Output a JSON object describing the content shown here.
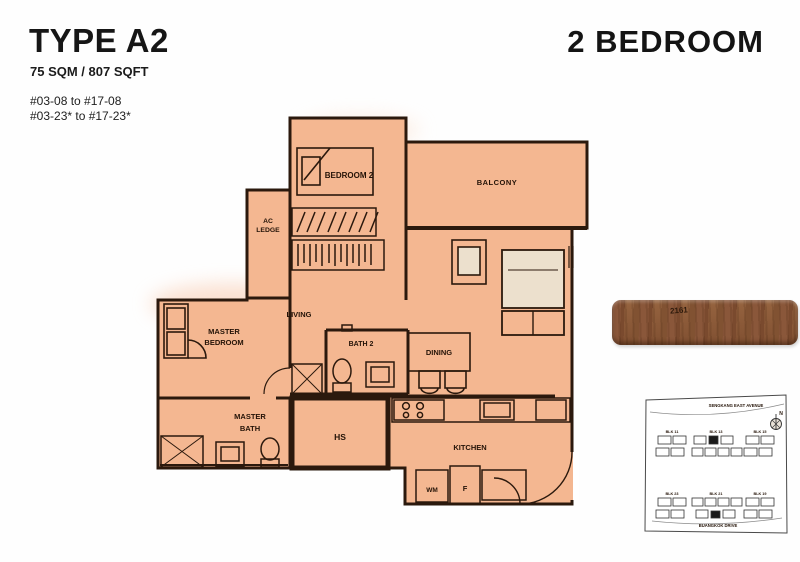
{
  "header": {
    "type_label": "TYPE A2",
    "area_label": "75 SQM / 807 SQFT",
    "unit_range_1": "#03-08 to #17-08",
    "unit_range_2": "#03-23* to #17-23*",
    "bedroom_label": "2 BEDROOM"
  },
  "floorplan": {
    "rooms": {
      "bedroom2": "BEDROOM 2",
      "balcony": "BALCONY",
      "ac_line1": "AC",
      "ac_line2": "LEDGE",
      "living": "LIVING",
      "master_line1": "MASTER",
      "master_line2": "BEDROOM",
      "bath2": "BATH 2",
      "dining": "DINING",
      "mbath_line1": "MASTER",
      "mbath_line2": "BATH",
      "hs": "HS",
      "kitchen": "KITCHEN",
      "wm": "WM",
      "fridge": "F"
    },
    "colors": {
      "fill": "#f4b791",
      "wall": "#2b190d",
      "bedding": "#ece0cd"
    }
  },
  "wood_bar": {
    "label": "2161"
  },
  "sitemap": {
    "street_top": "SENGKANG EAST AVENUE",
    "street_bottom": "BUANGKOK DRIVE",
    "north_label": "N",
    "blocks_top": [
      "BLK 11",
      "BLK 13",
      "BLK 15"
    ],
    "blocks_bottom": [
      "BLK 23",
      "BLK 21",
      "BLK 19"
    ]
  }
}
